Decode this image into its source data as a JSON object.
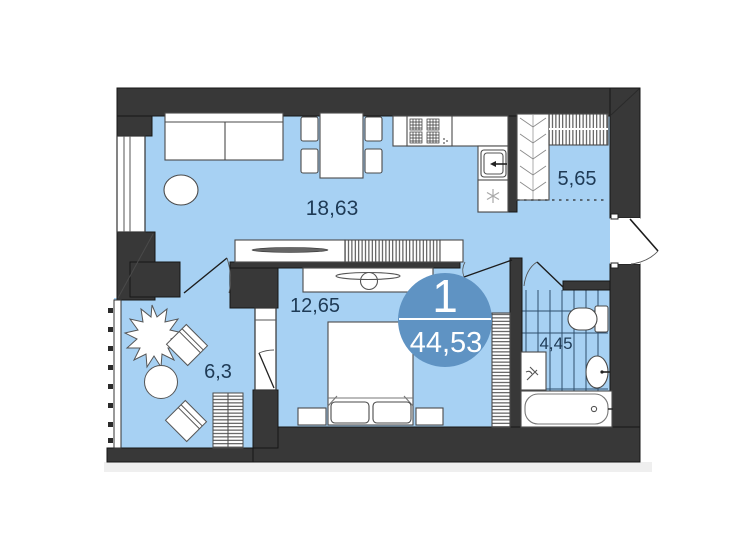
{
  "plan": {
    "title": "apartment-floor-plan",
    "unit_badge": {
      "number": "1",
      "total_area": "44,53"
    },
    "rooms": [
      {
        "name": "living-kitchen",
        "area_label": "18,63"
      },
      {
        "name": "hallway-wardrobe",
        "area_label": "5,65"
      },
      {
        "name": "bedroom",
        "area_label": "12,65"
      },
      {
        "name": "balcony",
        "area_label": "6,3"
      },
      {
        "name": "bathroom",
        "area_label": "4,45"
      }
    ],
    "colors": {
      "floor": "#a7d1f3",
      "wall": "#383838",
      "badge": "#5f93c3",
      "label_text": "#1e3a55",
      "furniture_fill": "#ffffff",
      "furniture_stroke": "#4a4a4a",
      "tile_line": "#2f4f6e"
    }
  }
}
